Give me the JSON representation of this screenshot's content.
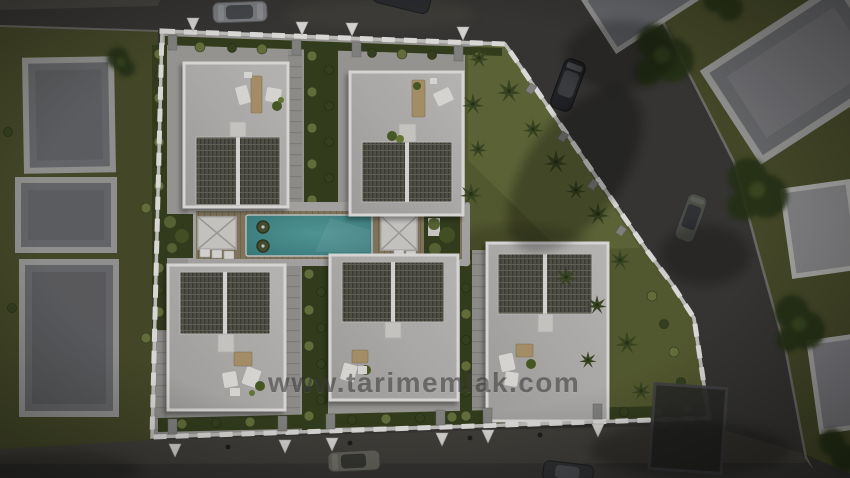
{
  "watermark": {
    "text": "www.tarimemlak.com"
  },
  "scene": {
    "description": "Aerial top-down 3D architectural render of a gated villa development",
    "villa_count": 5,
    "neighbor_buildings": 7,
    "cars_visible": 6,
    "entrance_markers_top": 4,
    "entrance_markers_bottom": 6,
    "pool": "central rectangular pool on a timber deck with two white pergolas and two pool floats"
  },
  "colors": {
    "road": "#3a3937",
    "sidewalk": "#46443f",
    "grass": "#4a4e2b",
    "lawn": "#5a6033",
    "lawnBright": "#6a7240",
    "hedge": "#37421f",
    "bushLight": "#6d7840",
    "bushDark": "#3a4522",
    "concrete": "#a5a3a0",
    "concreteLight": "#b4b2af",
    "paver": "#9c9a96",
    "wallLight": "#cfcecb",
    "wallWhite": "#f0efed",
    "villaParapet": "#ecebe9",
    "terrace": "#c1bfbd",
    "corrugated": "#56574d",
    "corrugatedDark": "#3f4037",
    "deck": "#8b7e66",
    "pool": "#4a9496",
    "poolDeep": "#3c8385",
    "buildingFrame": "#9e9e9c",
    "buildingRoof": "#6e6f72",
    "buildingRoofLit": "#8c8c8e",
    "treeDark": "#28331a",
    "palm": "#3d4a24",
    "marker": "#e9e8e6",
    "carSilver": "#85868a",
    "carBlack": "#232427",
    "carGray": "#53554f",
    "wood": "#b59c72",
    "furnitureWhite": "#eceae7",
    "watermark": "rgba(40,40,40,0.52)"
  }
}
